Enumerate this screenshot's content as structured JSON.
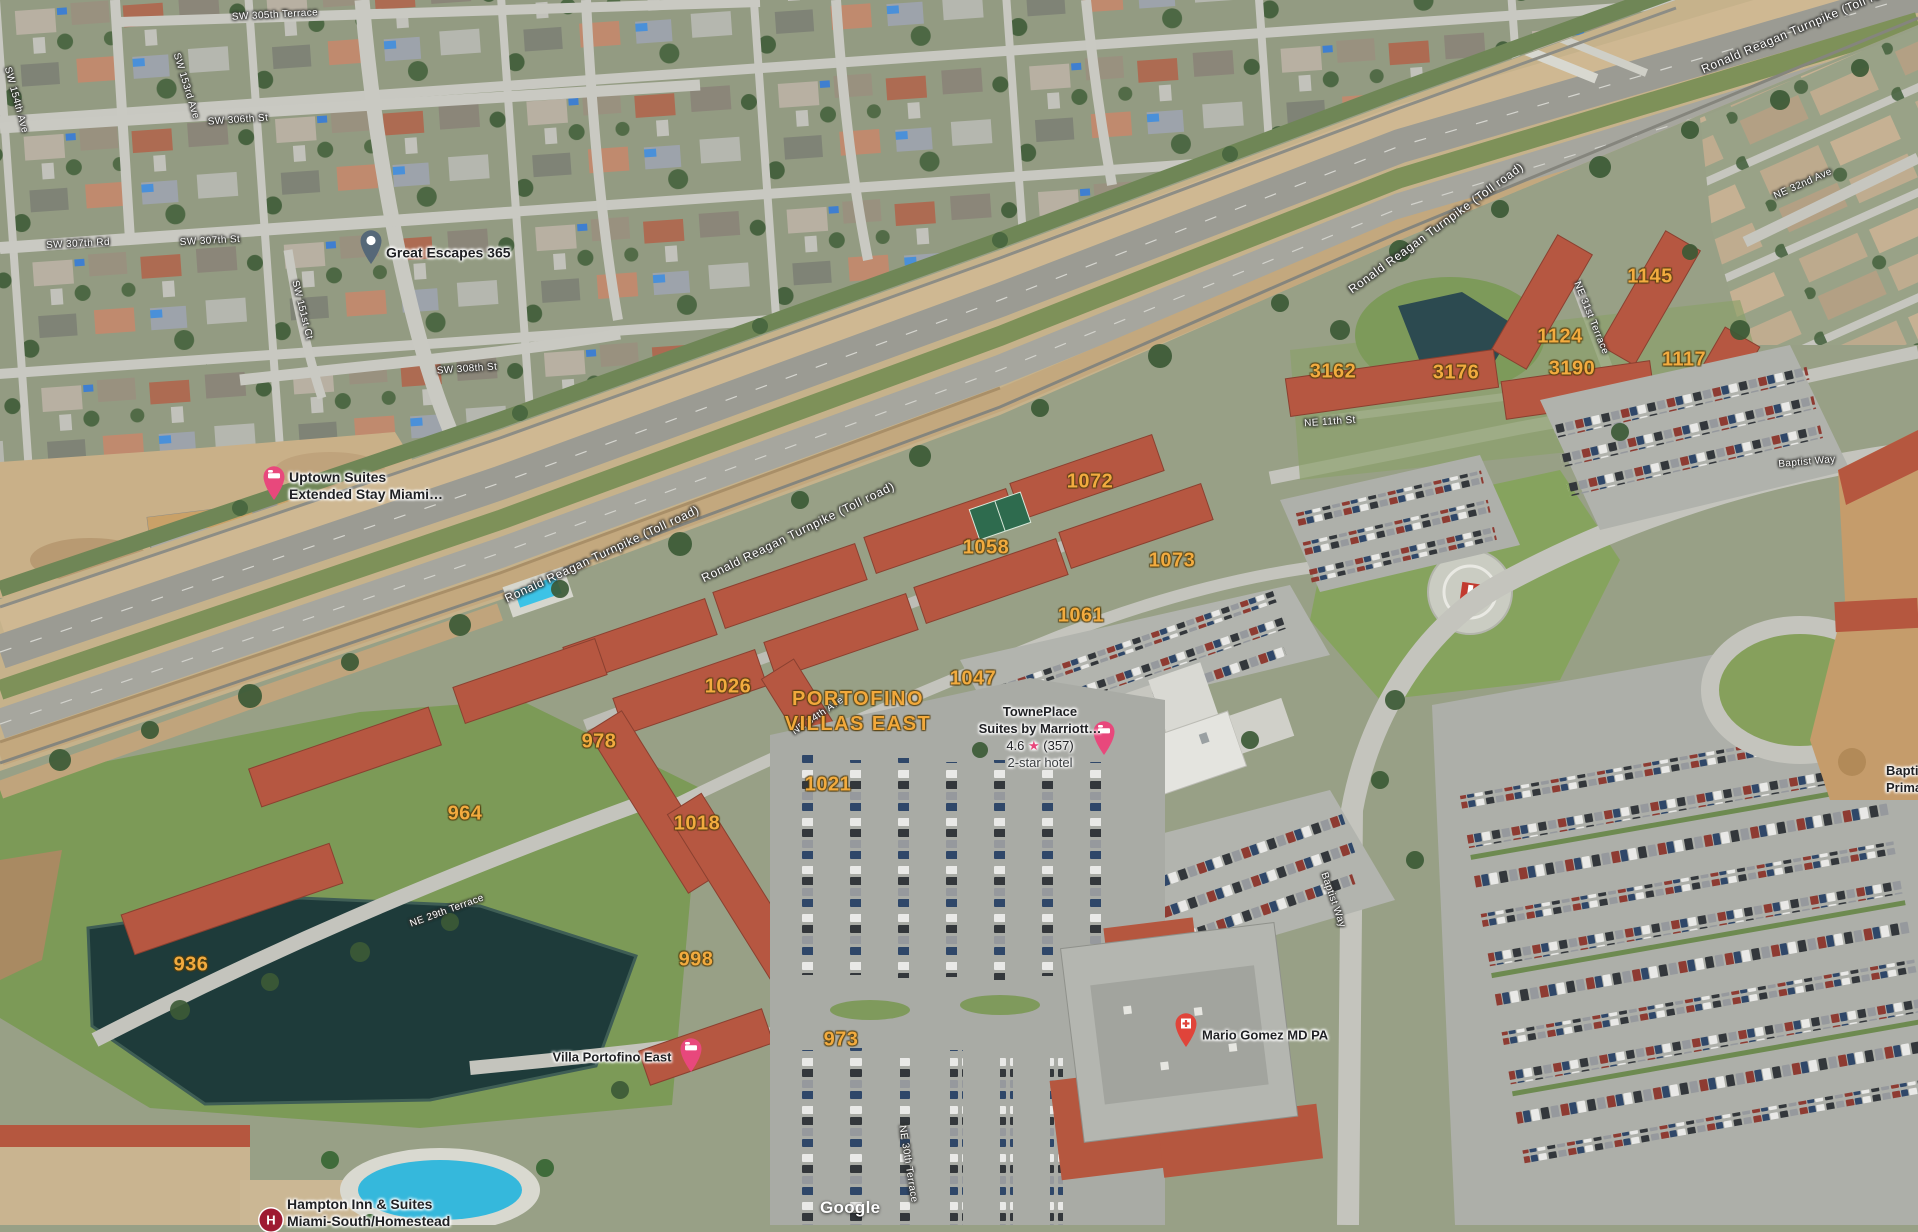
{
  "watermark": "Google",
  "area": {
    "line1": "PORTOFINO",
    "line2": "VILLAS EAST"
  },
  "streets": [
    {
      "name": "SW 305th Terrace"
    },
    {
      "name": "SW 153rd Ave"
    },
    {
      "name": "SW 306th St"
    },
    {
      "name": "SW 307th Rd"
    },
    {
      "name": "SW 307th St"
    },
    {
      "name": "SW 151st Ct"
    },
    {
      "name": "SW 308th St"
    },
    {
      "name": "SW 154th Ave"
    },
    {
      "name": "Ronald Reagan Turnpike (Toll road)"
    },
    {
      "name": "Ronald Reagan Turnpike (Toll road)"
    },
    {
      "name": "Ronald Reagan Turnpike (Toll road)"
    },
    {
      "name": "Ronald Reagan Turnpike (Toll road)"
    },
    {
      "name": "NE 11th St"
    },
    {
      "name": "NE 31st Terrace"
    },
    {
      "name": "NE 32nd Ave"
    },
    {
      "name": "Baptist Way"
    },
    {
      "name": "Baptist Way"
    },
    {
      "name": "NE 29th Terrace"
    },
    {
      "name": "NE 30th Terrace"
    },
    {
      "name": "NE 34th Ave"
    }
  ],
  "addresses": [
    {
      "n": "1145"
    },
    {
      "n": "1124"
    },
    {
      "n": "1117"
    },
    {
      "n": "3162"
    },
    {
      "n": "3176"
    },
    {
      "n": "3190"
    },
    {
      "n": "1072"
    },
    {
      "n": "1058"
    },
    {
      "n": "1073"
    },
    {
      "n": "1061"
    },
    {
      "n": "1026"
    },
    {
      "n": "1047"
    },
    {
      "n": "978"
    },
    {
      "n": "964"
    },
    {
      "n": "1018"
    },
    {
      "n": "1021"
    },
    {
      "n": "936"
    },
    {
      "n": "998"
    },
    {
      "n": "973"
    }
  ],
  "pois": {
    "great_escapes": {
      "name": "Great Escapes 365"
    },
    "uptown": {
      "line1": "Uptown Suites",
      "line2": "Extended Stay Miami…"
    },
    "towneplace": {
      "line1": "TownePlace",
      "line2": "Suites by Marriott…",
      "rating": "4.6",
      "star": "★",
      "reviews": "(357)",
      "category": "2-star hotel"
    },
    "villa": {
      "name": "Villa Portofino East"
    },
    "mario": {
      "name": "Mario Gomez MD PA"
    },
    "hampton": {
      "line1": "Hampton Inn & Suites",
      "line2": "Miami-South/Homestead",
      "logo_letter": "H"
    },
    "baptist": {
      "line1": "Baptist",
      "line2": "Primary"
    }
  },
  "colors": {
    "address_text": "#f2ab3f",
    "hotel_pin": "#e8487c",
    "doctor_pin": "#e0443a",
    "generic_pin": "#566878",
    "hampton_logo": "#9e1b32",
    "rating_star": "#e8487c"
  }
}
